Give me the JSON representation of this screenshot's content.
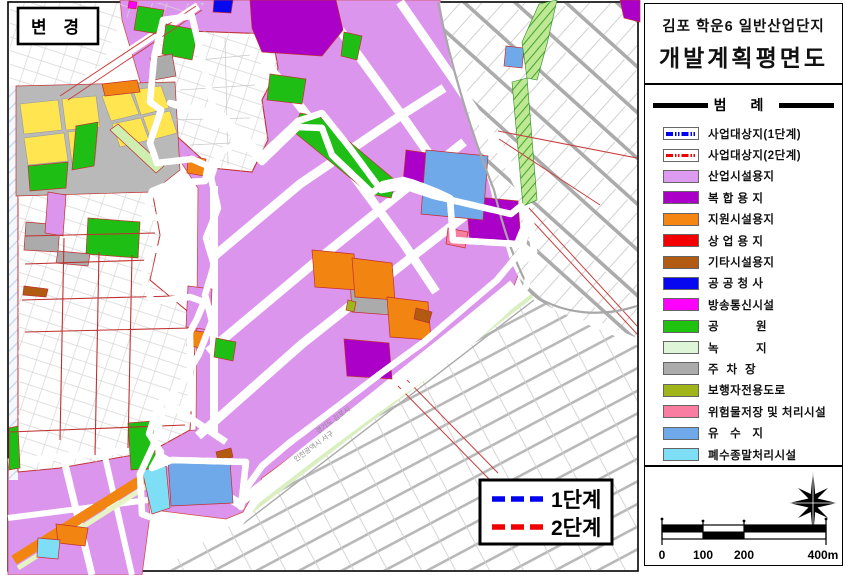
{
  "panel": {
    "title_line1": "김포 학운6 일반산업단지",
    "title_line2": "개발계획획평면도",
    "title_line2_fixed": "개발계획평면도",
    "legend_header": "범    례",
    "legend_items": [
      {
        "label": "사업대상지(1단계)",
        "type": "line",
        "color": "#0000F0"
      },
      {
        "label": "사업대상지(2단계)",
        "type": "line",
        "color": "#F00000"
      },
      {
        "label": "산업시설용지",
        "type": "fill",
        "color": "#DC9BF0"
      },
      {
        "label": "복 합 용 지",
        "type": "fill",
        "color": "#AA00C8"
      },
      {
        "label": "지원시설용지",
        "type": "fill",
        "color": "#F58611"
      },
      {
        "label": "상 업 용 지",
        "type": "fill",
        "color": "#F40000"
      },
      {
        "label": "기타시설용지",
        "type": "fill",
        "color": "#B05A12"
      },
      {
        "label": "공 공 청 사",
        "type": "fill",
        "color": "#0808F0"
      },
      {
        "label": "방송통신시설",
        "type": "fill",
        "color": "#FF00FF"
      },
      {
        "label": "공          원",
        "type": "fill",
        "color": "#1FC30F"
      },
      {
        "label": "녹          지",
        "type": "fill",
        "color": "#DEF5D8"
      },
      {
        "label": "주  차  장",
        "type": "fill",
        "color": "#ABABAB"
      },
      {
        "label": "보행자전용도로",
        "type": "fill",
        "color": "#9FB519"
      },
      {
        "label": "위험물저장 및 처리시설",
        "type": "fill",
        "color": "#F87DA0"
      },
      {
        "label": "유   수   지",
        "type": "fill",
        "color": "#6FA9E9"
      },
      {
        "label": "폐수종말처리시설",
        "type": "fill",
        "color": "#7EDEF5"
      }
    ],
    "scalebar": {
      "l0": "0",
      "l100": "100",
      "l200": "200",
      "l400": "400m"
    }
  },
  "map": {
    "change_label": "변  경",
    "phase1_label": "1단계",
    "phase2_label": "2단계",
    "admin_label_1": "경기도  김포시",
    "admin_label_2": "인천광역시  서구",
    "colors": {
      "industrial": "#DC95EC",
      "mixed": "#AA00C8",
      "support": "#F28411",
      "park": "#1FBE14",
      "reservoir": "#6FA9E9",
      "wastewater": "#7EDEF5",
      "phase1_line": "#0000F0",
      "phase2_line": "#F00000"
    }
  }
}
